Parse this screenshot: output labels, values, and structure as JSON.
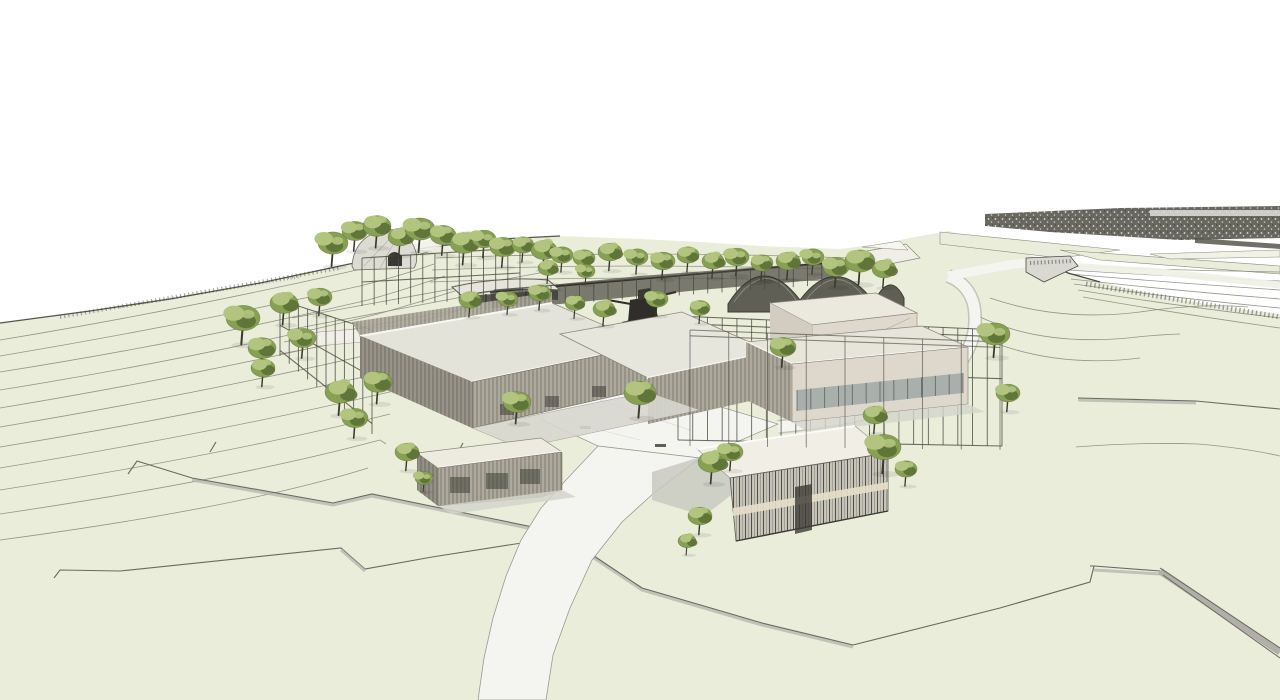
{
  "scene": {
    "title": "Hillside campus aerial sketch rendering",
    "description": "Sketch-style 3D architectural rendering of a hillside campus: flat-roofed slatted buildings, open pergola frames, a grey dome and dark barrel vaults, scattered trees, terraced contour lines and white winding footpaths over pale green terrain under a white sky.",
    "colors": {
      "terrain": "#eaedda",
      "terrain_light": "#f1f2e5",
      "path": "#f4f4f1",
      "path_edge": "#9a9a90",
      "contour": "#8b8b81",
      "ink": "#4b4a42",
      "roof": "#e4e3da",
      "roof_light": "#f6f6f0",
      "facade": "#b7b3a6",
      "facade_line": "#6e6b60",
      "wall_beige": "#ded9cc",
      "window": "#a9b0ac",
      "screen": "#c6c4b8",
      "dark_structure": "#4c4b42",
      "paving": "#cfcfc7",
      "band_dark": "#5c5b52",
      "shade": "#b7b7af",
      "tree_light": "#b2c47e",
      "tree_mid": "#87a053",
      "tree_dark": "#5c7036",
      "trunk": "#3b3a2f",
      "sky": "#ffffff"
    },
    "trees": [
      [
        333,
        243,
        15
      ],
      [
        355,
        231,
        13
      ],
      [
        377,
        226,
        14
      ],
      [
        400,
        237,
        12
      ],
      [
        420,
        229,
        15
      ],
      [
        443,
        235,
        13
      ],
      [
        464,
        243,
        14
      ],
      [
        484,
        239,
        12
      ],
      [
        503,
        247,
        13
      ],
      [
        523,
        245,
        11
      ],
      [
        544,
        250,
        13
      ],
      [
        562,
        255,
        11
      ],
      [
        584,
        258,
        11
      ],
      [
        610,
        252,
        12
      ],
      [
        637,
        257,
        11
      ],
      [
        663,
        261,
        12
      ],
      [
        688,
        255,
        11
      ],
      [
        713,
        261,
        11
      ],
      [
        737,
        257,
        12
      ],
      [
        762,
        263,
        11
      ],
      [
        788,
        261,
        12
      ],
      [
        813,
        257,
        11
      ],
      [
        836,
        267,
        13
      ],
      [
        860,
        261,
        15
      ],
      [
        884,
        269,
        12
      ],
      [
        243,
        318,
        17
      ],
      [
        262,
        348,
        14
      ],
      [
        284,
        303,
        14
      ],
      [
        303,
        338,
        13
      ],
      [
        320,
        297,
        12
      ],
      [
        263,
        368,
        12
      ],
      [
        340,
        392,
        15
      ],
      [
        355,
        418,
        13
      ],
      [
        378,
        382,
        14
      ],
      [
        470,
        300,
        11
      ],
      [
        508,
        299,
        10
      ],
      [
        540,
        293,
        11
      ],
      [
        575,
        303,
        10
      ],
      [
        604,
        309,
        11
      ],
      [
        657,
        299,
        11
      ],
      [
        700,
        308,
        10
      ],
      [
        548,
        268,
        10
      ],
      [
        586,
        271,
        9
      ],
      [
        517,
        402,
        14
      ],
      [
        640,
        393,
        16
      ],
      [
        712,
        462,
        14
      ],
      [
        731,
        452,
        12
      ],
      [
        783,
        347,
        13
      ],
      [
        875,
        415,
        12
      ],
      [
        995,
        334,
        15
      ],
      [
        1008,
        393,
        12
      ],
      [
        700,
        516,
        12
      ],
      [
        687,
        541,
        9
      ],
      [
        884,
        447,
        17
      ],
      [
        906,
        469,
        11
      ],
      [
        407,
        452,
        12
      ],
      [
        424,
        478,
        9
      ]
    ],
    "pergolas": {
      "back": [
        {
          "x0": 362,
          "yt0": 258,
          "yb0": 306,
          "x1": 520,
          "yt1": 248,
          "yb1": 298,
          "n": 13,
          "beams": [
            0,
            0.5
          ]
        },
        {
          "x0": 280,
          "yt0": 300,
          "yb0": 356,
          "x1": 372,
          "yt1": 330,
          "yb1": 434,
          "n": 10,
          "beams": [
            0,
            0.45,
            0.9
          ]
        },
        {
          "x0": 494,
          "yt0": 290,
          "yb0": 309,
          "x1": 836,
          "yt1": 263,
          "yb1": 284,
          "n": 24,
          "beams": [
            0
          ]
        },
        {
          "x0": 678,
          "yt0": 316,
          "yb0": 440,
          "x1": 1002,
          "yt1": 330,
          "yb1": 446,
          "n": 22,
          "beams": [
            0,
            0.06,
            0.42,
            1
          ]
        }
      ],
      "front": [
        {
          "x0": 690,
          "yt0": 330,
          "yb0": 446,
          "x1": 1000,
          "yt1": 342,
          "yb1": 450,
          "n": 8,
          "beams": [
            0,
            0.05
          ]
        },
        {
          "x0": 797,
          "yt0": 390,
          "yb0": 411,
          "x1": 963,
          "yt1": 373,
          "yb1": 393,
          "n": 12,
          "beams": []
        }
      ]
    }
  }
}
